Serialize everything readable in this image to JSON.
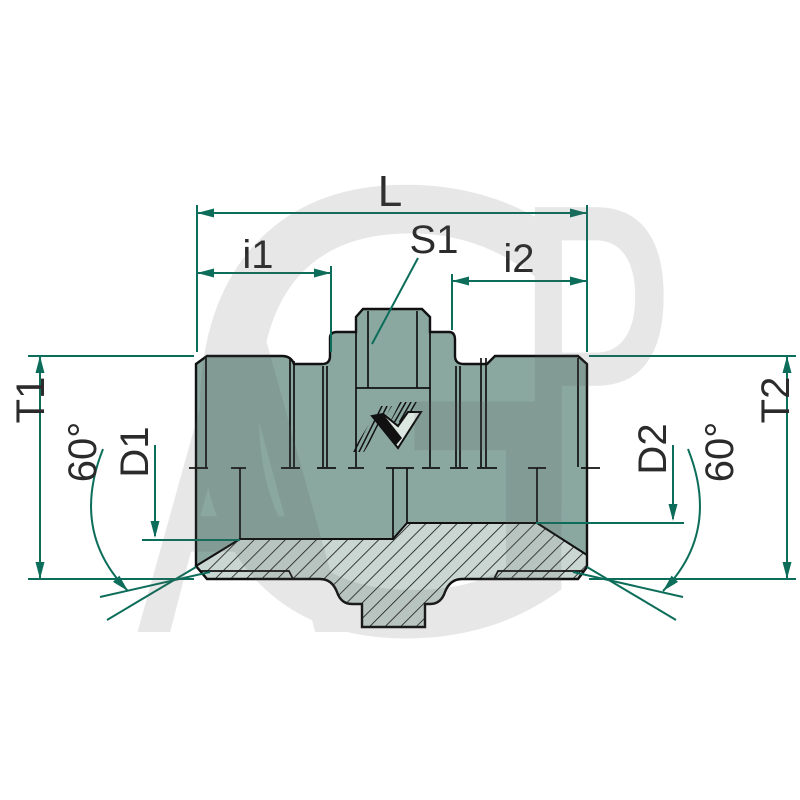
{
  "diagram": {
    "type": "hydraulic-adapter-technical-drawing",
    "labels": {
      "overall_length": "L",
      "thread_length_1": "i1",
      "hex_size": "S1",
      "thread_length_2": "i2",
      "thread_od_1": "T1",
      "cone_angle_1": "60°",
      "bore_1": "D1",
      "bore_2": "D2",
      "cone_angle_2": "60°",
      "thread_od_2": "T2"
    },
    "watermark": {
      "letter_a": "A",
      "letter_g": "G",
      "letter_p": "P"
    },
    "colors": {
      "dimension_green": "#0c6e5a",
      "body_fill": "#8aa7a0",
      "section_fill": "#c9d6d1",
      "outline": "#111111",
      "label_text": "#2b2b2b",
      "watermark_gray": "#5a5a5a"
    }
  }
}
